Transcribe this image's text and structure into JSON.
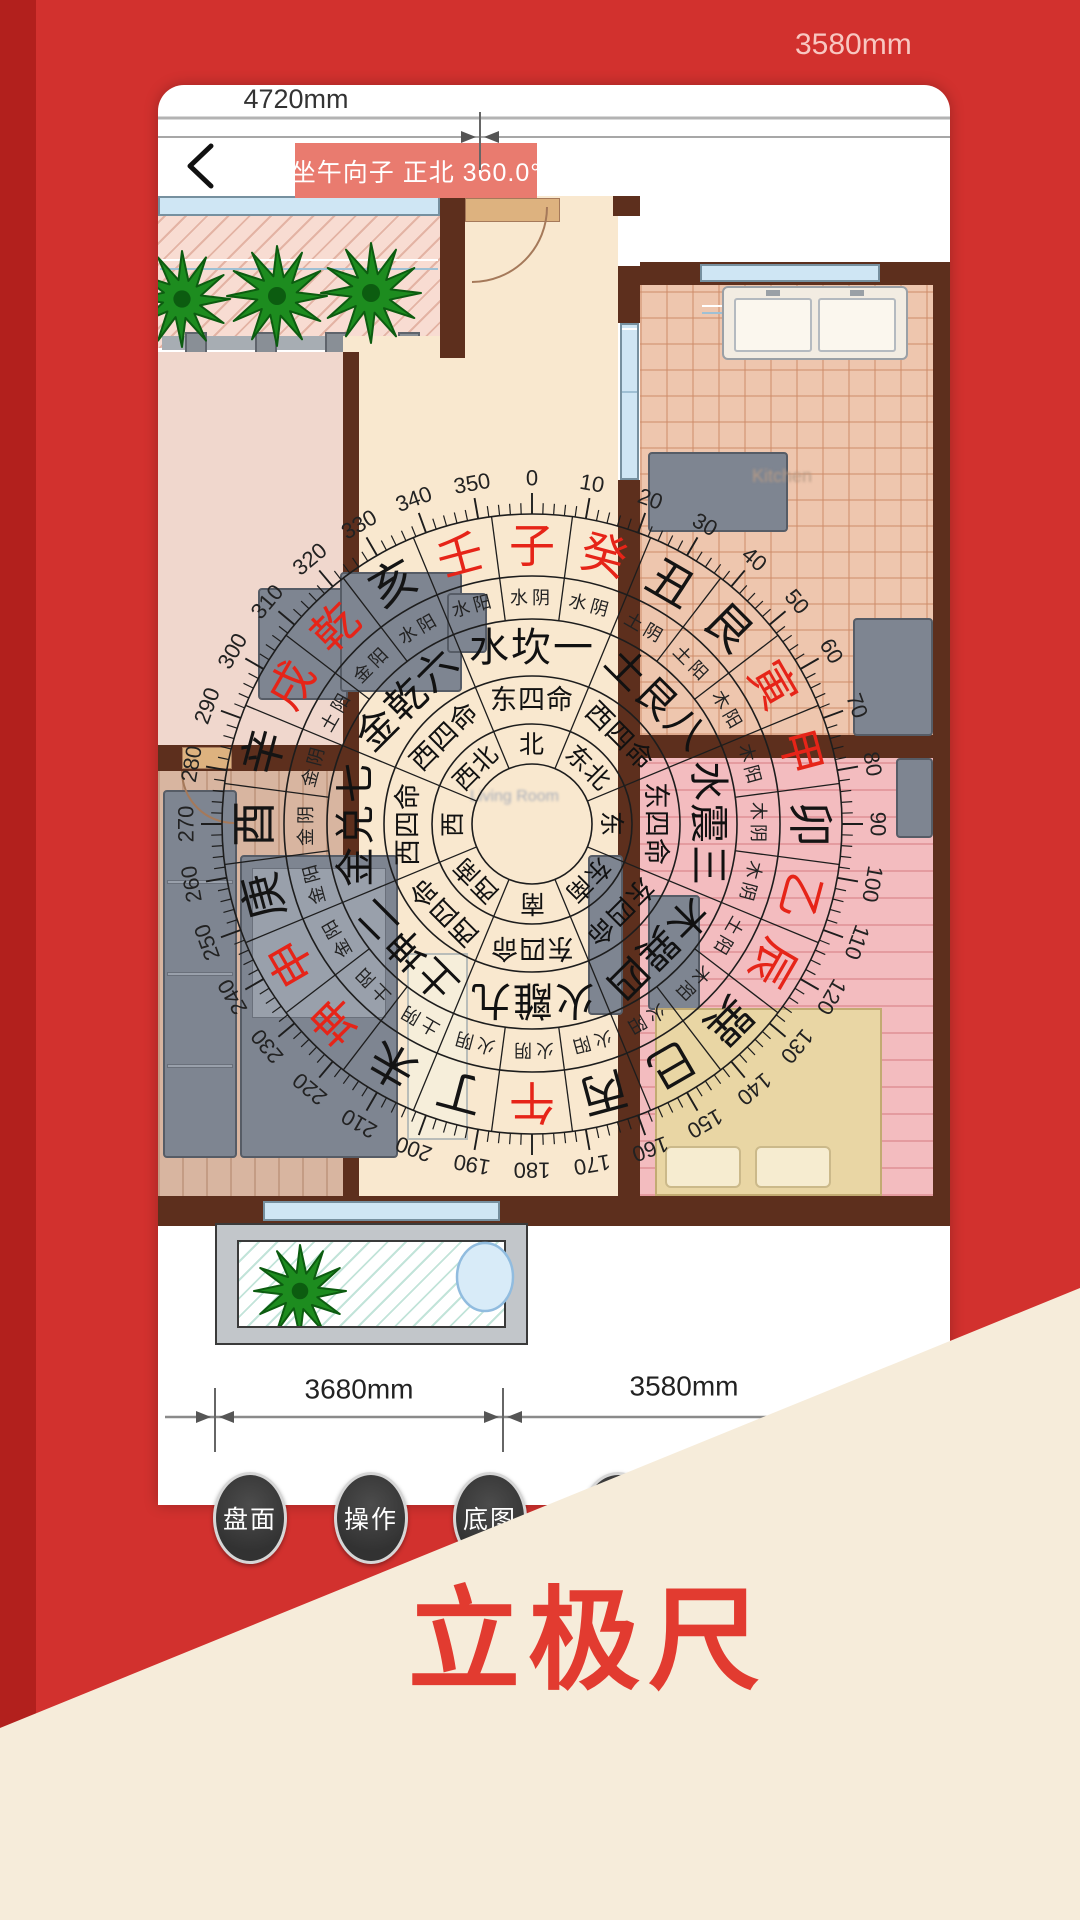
{
  "palette": {
    "app_red": "#d2312e",
    "app_red_dark": "#b2201d",
    "badge_red": "#e97b6f",
    "cream": "#f6ecda",
    "button_dark": "#3b3b3b",
    "mountain_red": "#e62418",
    "mountain_black": "#141414",
    "wall_brown": "#5d2f1d"
  },
  "header": {
    "back_icon": "chevron-left",
    "title": "坐午向子  正北 360.0°"
  },
  "top_dimension": {
    "label_left": "4720mm",
    "label_right_outside": "3580mm"
  },
  "bottom_dimension": {
    "label_left": "3680mm",
    "label_right": "3580mm"
  },
  "rooms": {
    "kitchen_label": "Kitchen",
    "living_label": "Living Room"
  },
  "buttons": [
    {
      "label": "盘面"
    },
    {
      "label": "操作"
    },
    {
      "label": "底图"
    },
    {
      "label": ""
    }
  ],
  "watermark": "立极尺",
  "compass": {
    "degrees": [
      0,
      10,
      20,
      30,
      40,
      50,
      60,
      70,
      80,
      90,
      100,
      110,
      120,
      130,
      140,
      150,
      160,
      170,
      180,
      190,
      200,
      210,
      220,
      230,
      240,
      250,
      260,
      270,
      280,
      290,
      300,
      310,
      320,
      330,
      340,
      350
    ],
    "directions": [
      "北",
      "东北",
      "东",
      "东南",
      "南",
      "西南",
      "西",
      "西北"
    ],
    "ming": [
      "东四命",
      "西四命",
      "东四命",
      "东四命",
      "东四命",
      "西四命",
      "西四命",
      "西四命"
    ],
    "trigrams": [
      "水坎一",
      "土艮八",
      "水震三",
      "木巽四",
      "火離九",
      "土坤二",
      "金兑七",
      "金乾六"
    ],
    "mountains": [
      {
        "name": "子",
        "color": "red",
        "element": "水阴"
      },
      {
        "name": "癸",
        "color": "red",
        "element": "水阴"
      },
      {
        "name": "丑",
        "color": "black",
        "element": "土阴"
      },
      {
        "name": "艮",
        "color": "black",
        "element": "土阳"
      },
      {
        "name": "寅",
        "color": "red",
        "element": "木阳"
      },
      {
        "name": "甲",
        "color": "red",
        "element": "木阳"
      },
      {
        "name": "卯",
        "color": "black",
        "element": "木阴"
      },
      {
        "name": "乙",
        "color": "red",
        "element": "木阴"
      },
      {
        "name": "辰",
        "color": "red",
        "element": "土阳"
      },
      {
        "name": "巽",
        "color": "black",
        "element": "木阳"
      },
      {
        "name": "巳",
        "color": "black",
        "element": "火阳"
      },
      {
        "name": "丙",
        "color": "black",
        "element": "火阳"
      },
      {
        "name": "午",
        "color": "red",
        "element": "火阴"
      },
      {
        "name": "丁",
        "color": "black",
        "element": "火阴"
      },
      {
        "name": "未",
        "color": "black",
        "element": "土阴"
      },
      {
        "name": "坤",
        "color": "red",
        "element": "土阳"
      },
      {
        "name": "申",
        "color": "red",
        "element": "金阳"
      },
      {
        "name": "庚",
        "color": "black",
        "element": "金阳"
      },
      {
        "name": "酉",
        "color": "black",
        "element": "金阴"
      },
      {
        "name": "辛",
        "color": "black",
        "element": "金阴"
      },
      {
        "name": "戌",
        "color": "red",
        "element": "土阳"
      },
      {
        "name": "乾",
        "color": "red",
        "element": "金阳"
      },
      {
        "name": "亥",
        "color": "black",
        "element": "水阳"
      },
      {
        "name": "壬",
        "color": "red",
        "element": "水阳"
      }
    ]
  }
}
